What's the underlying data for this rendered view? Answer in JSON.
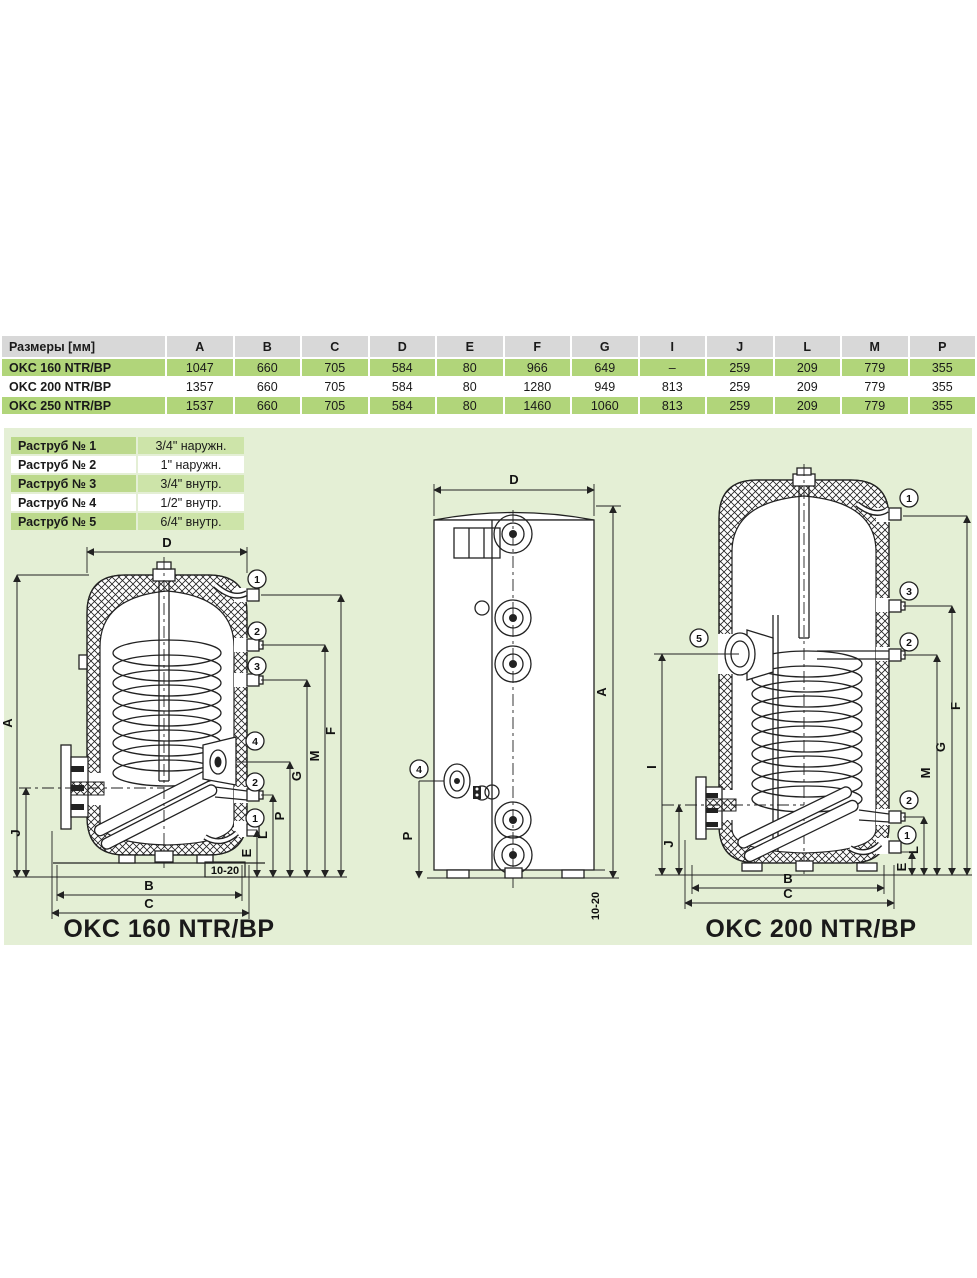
{
  "table": {
    "header": [
      "Размеры [мм]",
      "A",
      "B",
      "C",
      "D",
      "E",
      "F",
      "G",
      "I",
      "J",
      "L",
      "M",
      "P"
    ],
    "rows": [
      {
        "name": "OKC 160 NTR/BP",
        "values": [
          "1047",
          "660",
          "705",
          "584",
          "80",
          "966",
          "649",
          "–",
          "259",
          "209",
          "779",
          "355"
        ]
      },
      {
        "name": "OKC 200 NTR/BP",
        "values": [
          "1357",
          "660",
          "705",
          "584",
          "80",
          "1280",
          "949",
          "813",
          "259",
          "209",
          "779",
          "355"
        ]
      },
      {
        "name": "OKC 250 NTR/BP",
        "values": [
          "1537",
          "660",
          "705",
          "584",
          "80",
          "1460",
          "1060",
          "813",
          "259",
          "209",
          "779",
          "355"
        ]
      }
    ]
  },
  "legend": {
    "rows": [
      {
        "label": "Раструб № 1",
        "value": "3/4\" наружн."
      },
      {
        "label": "Раструб № 2",
        "value": "1\" наружн."
      },
      {
        "label": "Раструб № 3",
        "value": "3/4\" внутр."
      },
      {
        "label": "Раструб № 4",
        "value": "1/2\" внутр."
      },
      {
        "label": "Раструб № 5",
        "value": "6/4\" внутр."
      }
    ]
  },
  "drawings": {
    "left": {
      "title": "OKC 160 NTR/BP",
      "dims": {
        "D": "D",
        "A": "A",
        "J": "J",
        "B": "B",
        "C": "C",
        "E": "E",
        "L": "L",
        "P": "P",
        "G": "G",
        "M": "M",
        "F": "F",
        "gap": "10-20"
      },
      "callouts": [
        "1",
        "2",
        "3",
        "4",
        "2",
        "1"
      ]
    },
    "middle": {
      "dims": {
        "D": "D",
        "A": "A",
        "P": "P",
        "gap": "10-20"
      },
      "callouts": [
        "4"
      ]
    },
    "right": {
      "title": "OKC 200 NTR/BP",
      "dims": {
        "I": "I",
        "J": "J",
        "B": "B",
        "C": "C",
        "E": "E",
        "L": "L",
        "M": "M",
        "G": "G",
        "F": "F"
      },
      "callouts": [
        "1",
        "3",
        "2",
        "5",
        "2",
        "1"
      ]
    }
  },
  "colors": {
    "panel_bg": "#e4efd5",
    "table_row_green": "#b1d57a",
    "legend_label_green": "#bcd98c",
    "legend_value_green": "#cde4a9",
    "header_gray": "#d8d8d8",
    "line": "#222222"
  }
}
